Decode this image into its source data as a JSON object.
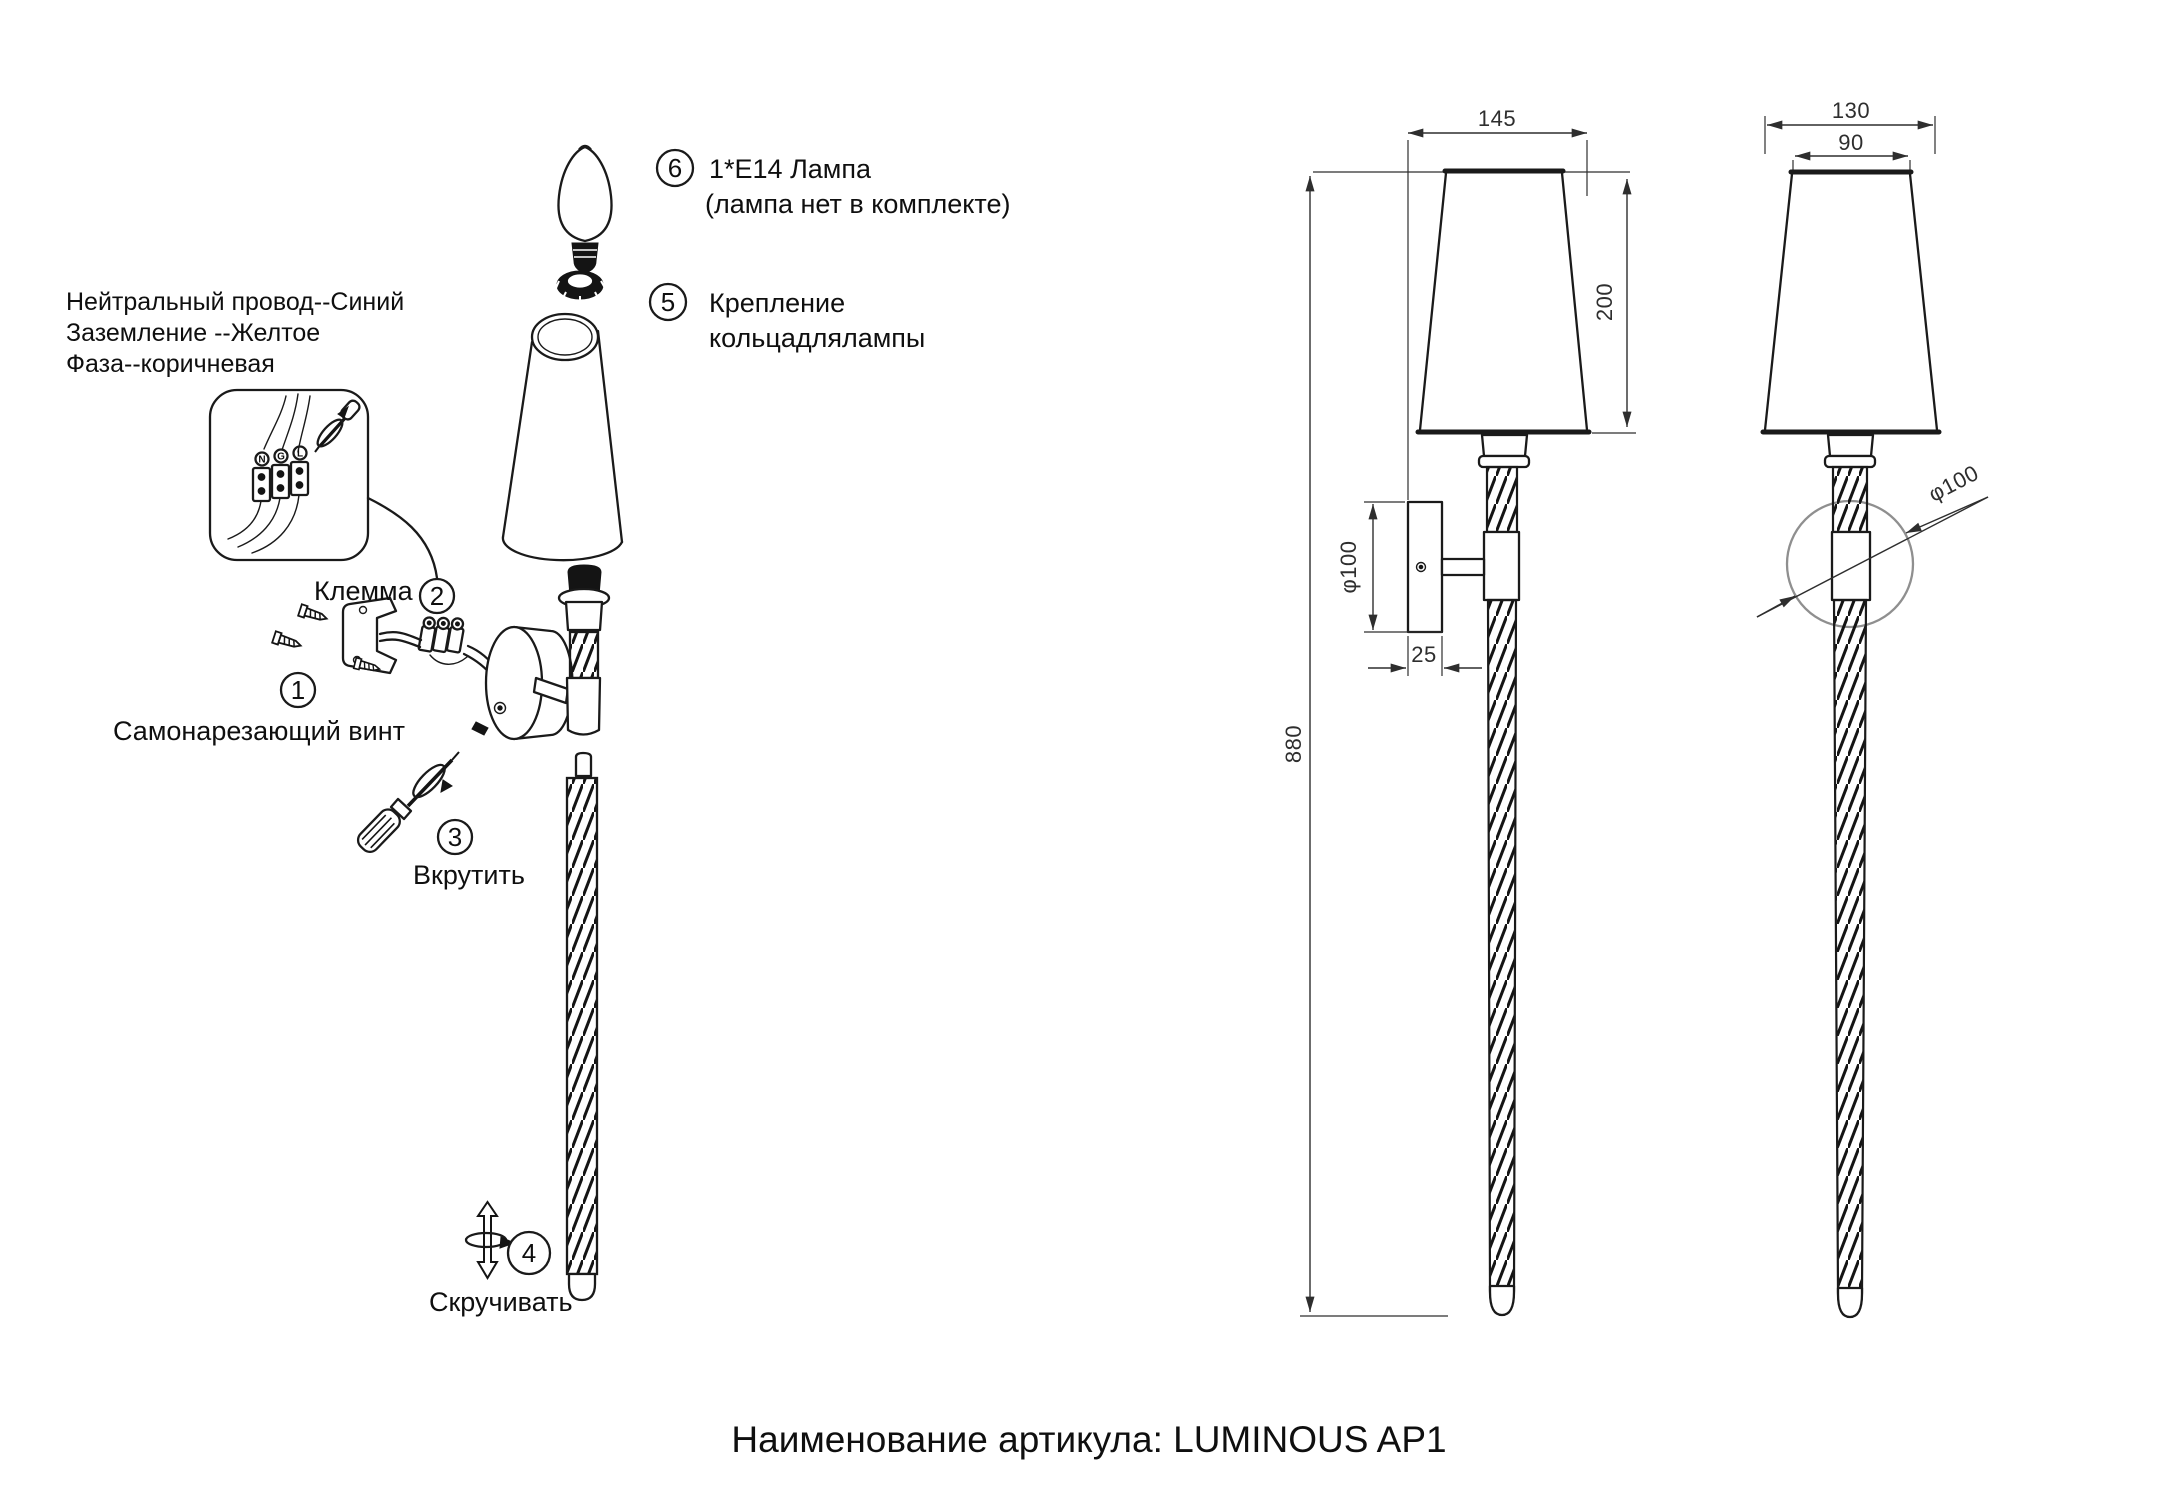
{
  "title": "Наименование артикула: LUMINOUS AP1",
  "steps": [
    {
      "num": "1",
      "label": "Самонарезающий винт"
    },
    {
      "num": "2",
      "label": "Клемма"
    },
    {
      "num": "3",
      "label": "Вкрутить"
    },
    {
      "num": "4",
      "label": "Скручивать"
    },
    {
      "num": "5",
      "line1": "Крепление",
      "line2": "кольцадлялампы"
    },
    {
      "num": "6",
      "line1": "1*E14 Лампа",
      "line2": "(лампа нет в комплекте)"
    }
  ],
  "wiring_note": {
    "line1": "Нейтральный провод--Синий",
    "line2": "Заземление --Желтое",
    "line3": "Фаза--коричневая"
  },
  "terminal_labels": {
    "neutral": "N",
    "ground": "G",
    "live": "L"
  },
  "dimensions": {
    "front_view": {
      "shade_width": "145",
      "shade_height": "200",
      "total_height": "880",
      "backplate_diameter": "φ100",
      "backplate_depth": "25"
    },
    "side_view": {
      "shade_bottom_width": "130",
      "shade_top_width": "90",
      "backplate_diameter": "φ100"
    }
  },
  "colors": {
    "ink": "#1a1a1a",
    "dim_ink": "#2e2e2e",
    "background": "#ffffff"
  }
}
